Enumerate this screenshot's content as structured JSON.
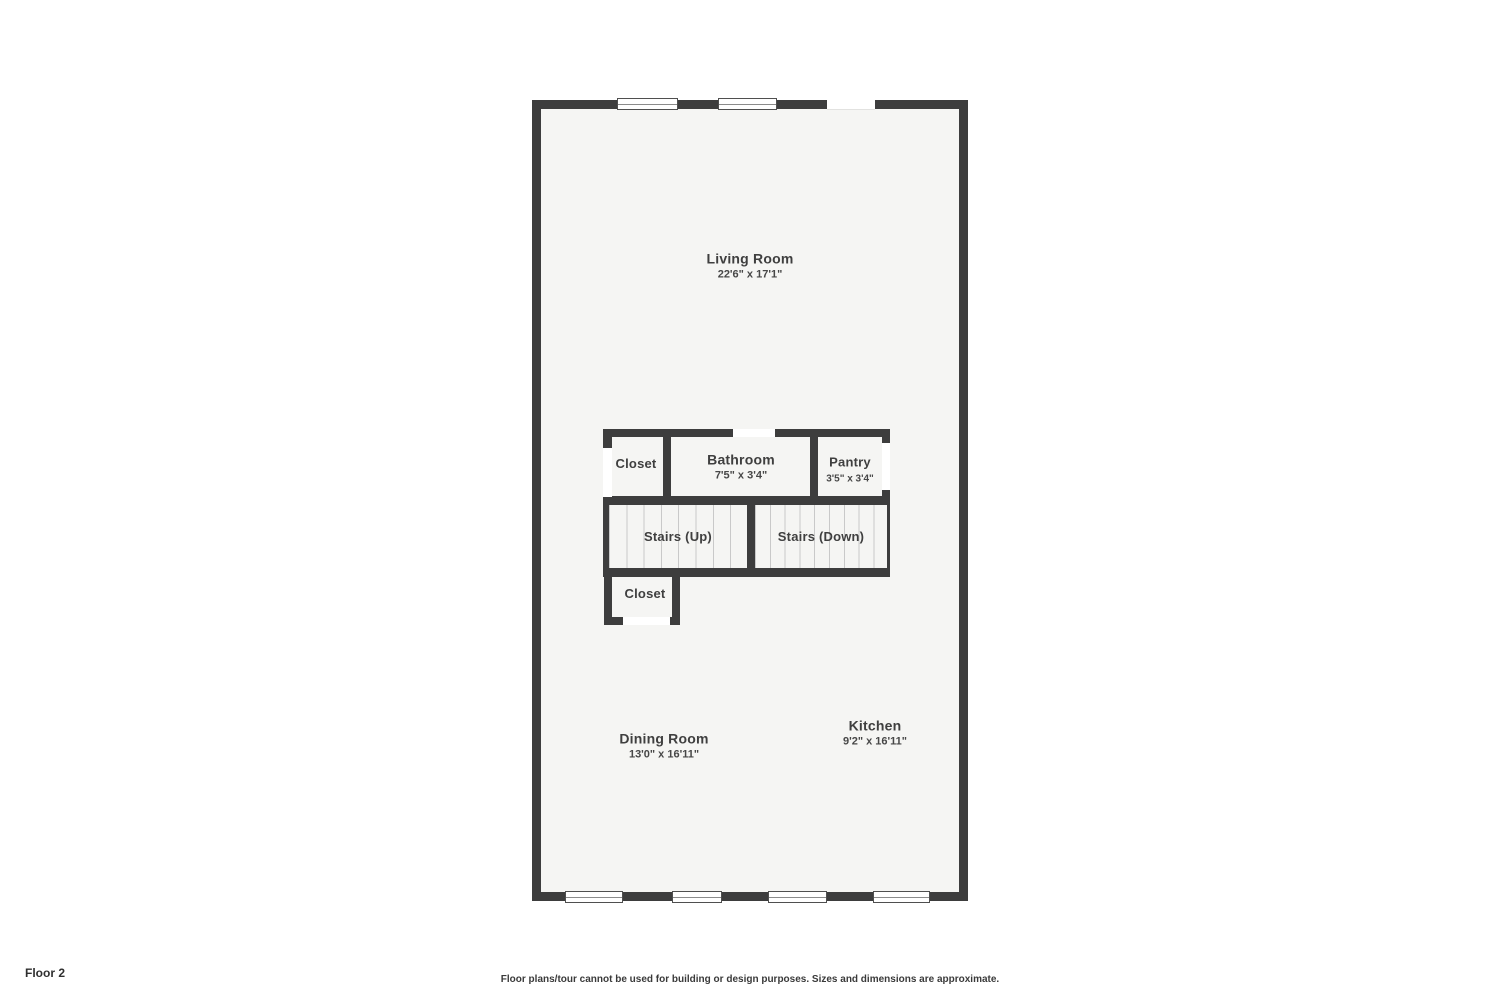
{
  "page": {
    "floor_label": "Floor 2",
    "disclaimer": "Floor plans/tour cannot be used for building or design purposes. Sizes and dimensions are approximate."
  },
  "colors": {
    "wall": "#3d3d3d",
    "floor": "#f5f5f3",
    "opening": "#ffffff",
    "stair_tread_line": "#c9c9c9",
    "label_text": "#3f3f3f"
  },
  "rooms": {
    "living_room": {
      "name": "Living Room",
      "dims": "22'6\" x 17'1\""
    },
    "closet_upper": {
      "name": "Closet"
    },
    "bathroom": {
      "name": "Bathroom",
      "dims": "7'5\" x 3'4\""
    },
    "pantry": {
      "name": "Pantry",
      "dims": "3'5\" x 3'4\""
    },
    "stairs_up": {
      "name": "Stairs (Up)"
    },
    "stairs_down": {
      "name": "Stairs (Down)"
    },
    "closet_lower": {
      "name": "Closet"
    },
    "dining_room": {
      "name": "Dining Room",
      "dims": "13'0\" x 16'11\""
    },
    "kitchen": {
      "name": "Kitchen",
      "dims": "9'2\" x 16'11\""
    }
  }
}
